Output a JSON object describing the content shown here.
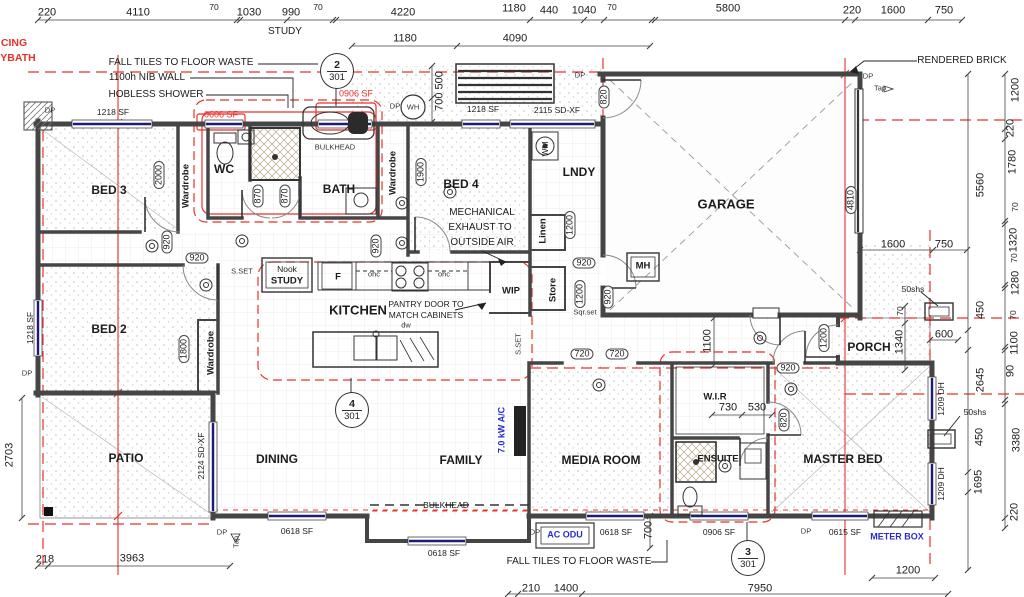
{
  "colors": {
    "red_line": "#e8312a",
    "window_blue": "#1b1b78",
    "label_blue": "#2a2ad0",
    "wall": "#454545"
  },
  "ref_circles": [
    {
      "num": "2",
      "sheet": "301"
    },
    {
      "num": "4",
      "sheet": "301"
    },
    {
      "num": "3",
      "sheet": "301"
    }
  ],
  "labels": [
    {
      "t": "220",
      "n": "dim-label",
      "k": "dim",
      "x": 47,
      "y": 13
    },
    {
      "t": "4110",
      "n": "dim-label",
      "k": "dim",
      "x": 138,
      "y": 13
    },
    {
      "t": "70",
      "n": "dim-label",
      "k": "dimsm",
      "x": 214,
      "y": 7
    },
    {
      "t": "1030",
      "n": "dim-label",
      "k": "dim",
      "x": 249,
      "y": 13
    },
    {
      "t": "990",
      "n": "dim-label",
      "k": "dim",
      "x": 291,
      "y": 13
    },
    {
      "t": "70",
      "n": "dim-label",
      "k": "dimsm",
      "x": 318,
      "y": 7
    },
    {
      "t": "4220",
      "n": "dim-label",
      "k": "dim",
      "x": 403,
      "y": 13
    },
    {
      "t": "1180",
      "n": "dim-label",
      "k": "dim",
      "x": 514,
      "y": 9
    },
    {
      "t": "440",
      "n": "dim-label",
      "k": "dim",
      "x": 549,
      "y": 11
    },
    {
      "t": "1040",
      "n": "dim-label",
      "k": "dim",
      "x": 584,
      "y": 11
    },
    {
      "t": "70",
      "n": "dim-label",
      "k": "dimsm",
      "x": 612,
      "y": 7
    },
    {
      "t": "5800",
      "n": "dim-label",
      "k": "dim",
      "x": 728,
      "y": 9
    },
    {
      "t": "220",
      "n": "dim-label",
      "k": "dim",
      "x": 852,
      "y": 11
    },
    {
      "t": "1600",
      "n": "dim-label",
      "k": "dim",
      "x": 893,
      "y": 11
    },
    {
      "t": "750",
      "n": "dim-label",
      "k": "dim",
      "x": 944,
      "y": 11
    },
    {
      "t": "STUDY",
      "n": "area-label-study",
      "k": "note",
      "x": 285,
      "y": 32
    },
    {
      "t": "1180",
      "n": "dim-label",
      "k": "dim",
      "x": 405,
      "y": 39
    },
    {
      "t": "4090",
      "n": "dim-label",
      "k": "dim",
      "x": 515,
      "y": 39
    },
    {
      "t": "700 500",
      "n": "dim-label",
      "k": "dim",
      "x": 440,
      "y": 91,
      "r": 1
    },
    {
      "t": "1200",
      "n": "dim-label",
      "k": "dim",
      "x": 1016,
      "y": 90,
      "r": 1
    },
    {
      "t": "220",
      "n": "dim-label",
      "k": "dim",
      "x": 1011,
      "y": 128,
      "r": 1
    },
    {
      "t": "1780",
      "n": "dim-label",
      "k": "dim",
      "x": 1013,
      "y": 162,
      "r": 1
    },
    {
      "t": "70",
      "n": "dim-label",
      "k": "dimsm",
      "x": 1015,
      "y": 207,
      "r": 1
    },
    {
      "t": "1320",
      "n": "dim-label",
      "k": "dim",
      "x": 1014,
      "y": 240,
      "r": 1
    },
    {
      "t": "70",
      "n": "dim-label",
      "k": "dimsm",
      "x": 1014,
      "y": 258,
      "r": 1
    },
    {
      "t": "1280",
      "n": "dim-label",
      "k": "dim",
      "x": 1016,
      "y": 283,
      "r": 1
    },
    {
      "t": "70",
      "n": "dim-label",
      "k": "dimsm",
      "x": 1013,
      "y": 315,
      "r": 1
    },
    {
      "t": "1100",
      "n": "dim-label",
      "k": "dim",
      "x": 1015,
      "y": 343,
      "r": 1
    },
    {
      "t": "90",
      "n": "dim-label",
      "k": "dim",
      "x": 1011,
      "y": 371,
      "r": 1
    },
    {
      "t": "3380",
      "n": "dim-label",
      "k": "dim",
      "x": 1017,
      "y": 440,
      "r": 1
    },
    {
      "t": "220",
      "n": "dim-label",
      "k": "dim",
      "x": 1015,
      "y": 512,
      "r": 1
    },
    {
      "t": "5560",
      "n": "dim-label",
      "k": "dim",
      "x": 981,
      "y": 185,
      "r": 1
    },
    {
      "t": "450",
      "n": "dim-label",
      "k": "dim",
      "x": 981,
      "y": 310,
      "r": 1
    },
    {
      "t": "2645",
      "n": "dim-label",
      "k": "dim",
      "x": 981,
      "y": 380,
      "r": 1
    },
    {
      "t": "450",
      "n": "dim-label",
      "k": "dim",
      "x": 980,
      "y": 437,
      "r": 1
    },
    {
      "t": "1695",
      "n": "dim-label",
      "k": "dim",
      "x": 979,
      "y": 482,
      "r": 1
    },
    {
      "t": "1600",
      "n": "dim-label",
      "k": "dim",
      "x": 893,
      "y": 245
    },
    {
      "t": "750",
      "n": "dim-label",
      "k": "dim",
      "x": 944,
      "y": 245
    },
    {
      "t": "50shs",
      "n": "post-label",
      "k": "dimsm",
      "x": 913,
      "y": 289
    },
    {
      "t": "70",
      "n": "dim-label",
      "k": "dimsm",
      "x": 900,
      "y": 311,
      "r": 1
    },
    {
      "t": "1340",
      "n": "dim-label",
      "k": "dim",
      "x": 900,
      "y": 342,
      "r": 1
    },
    {
      "t": "600",
      "n": "dim-label",
      "k": "dim",
      "x": 944,
      "y": 335
    },
    {
      "t": "50shs",
      "n": "post-label",
      "k": "dimsm",
      "x": 975,
      "y": 412
    },
    {
      "t": "1209 DH",
      "n": "window-size-label",
      "k": "dimsm",
      "x": 941,
      "y": 399,
      "r": 1
    },
    {
      "t": "1209 DH",
      "n": "window-size-label",
      "k": "dimsm",
      "x": 941,
      "y": 484,
      "r": 1
    },
    {
      "t": "1100",
      "n": "dim-label",
      "k": "dim",
      "x": 708,
      "y": 341,
      "r": 1
    },
    {
      "t": "218",
      "n": "dim-label",
      "k": "dim",
      "x": 45,
      "y": 560
    },
    {
      "t": "3963",
      "n": "dim-label",
      "k": "dim",
      "x": 132,
      "y": 559
    },
    {
      "t": "210",
      "n": "dim-label",
      "k": "dim",
      "x": 531,
      "y": 589
    },
    {
      "t": "1400",
      "n": "dim-label",
      "k": "dim",
      "x": 566,
      "y": 589
    },
    {
      "t": "7950",
      "n": "dim-label",
      "k": "dim",
      "x": 760,
      "y": 589
    },
    {
      "t": "1200",
      "n": "dim-label",
      "k": "dim",
      "x": 908,
      "y": 571
    },
    {
      "t": "700",
      "n": "dim-label",
      "k": "dim",
      "x": 649,
      "y": 530,
      "r": 1
    },
    {
      "t": "2703",
      "n": "dim-label",
      "k": "dim",
      "x": 10,
      "y": 455,
      "r": 1
    },
    {
      "t": "730",
      "n": "dim-label",
      "k": "dim",
      "x": 728,
      "y": 408
    },
    {
      "t": "530",
      "n": "dim-label",
      "k": "dim",
      "x": 757,
      "y": 408
    },
    {
      "t": "1218 SF",
      "n": "window-label",
      "k": "win",
      "x": 113,
      "y": 112
    },
    {
      "t": "0606 SF",
      "n": "window-label",
      "k": "winred",
      "x": 221,
      "y": 115
    },
    {
      "t": "0906 SF",
      "n": "window-label",
      "k": "winred",
      "x": 356,
      "y": 94
    },
    {
      "t": "1218 SF",
      "n": "window-label",
      "k": "win",
      "x": 483,
      "y": 109
    },
    {
      "t": "2115 SD-XF",
      "n": "window-label",
      "k": "win",
      "x": 557,
      "y": 110
    },
    {
      "t": "1218 SF",
      "n": "window-label",
      "k": "win",
      "x": 30,
      "y": 328,
      "r": 1
    },
    {
      "t": "2124 SD-XF",
      "n": "window-label",
      "k": "win",
      "x": 201,
      "y": 456,
      "r": 1
    },
    {
      "t": "0618 SF",
      "n": "window-label",
      "k": "win",
      "x": 297,
      "y": 531
    },
    {
      "t": "0618 SF",
      "n": "window-label",
      "k": "win",
      "x": 444,
      "y": 553
    },
    {
      "t": "0618 SF",
      "n": "window-label",
      "k": "win",
      "x": 616,
      "y": 532
    },
    {
      "t": "0906 SF",
      "n": "window-label",
      "k": "win",
      "x": 719,
      "y": 532
    },
    {
      "t": "0615 SF",
      "n": "window-label",
      "k": "win",
      "x": 845,
      "y": 532
    },
    {
      "t": "2000",
      "n": "door-size-tag",
      "k": "tag",
      "x": 159,
      "y": 175,
      "r": 1
    },
    {
      "t": "870",
      "n": "door-size-tag",
      "k": "tag",
      "x": 258,
      "y": 196,
      "r": 1
    },
    {
      "t": "870",
      "n": "door-size-tag",
      "k": "tag",
      "x": 285,
      "y": 196,
      "r": 1
    },
    {
      "t": "920",
      "n": "door-size-tag",
      "k": "tag",
      "x": 167,
      "y": 242,
      "r": 1
    },
    {
      "t": "920",
      "n": "door-size-tag",
      "k": "tag",
      "x": 197,
      "y": 258
    },
    {
      "t": "1800",
      "n": "door-size-tag",
      "k": "tag",
      "x": 184,
      "y": 349,
      "r": 1
    },
    {
      "t": "1900",
      "n": "door-size-tag",
      "k": "tag",
      "x": 421,
      "y": 172,
      "r": 1
    },
    {
      "t": "920",
      "n": "door-size-tag",
      "k": "tag",
      "x": 376,
      "y": 246,
      "r": 1
    },
    {
      "t": "1200",
      "n": "door-size-tag",
      "k": "tag",
      "x": 570,
      "y": 225,
      "r": 1
    },
    {
      "t": "920",
      "n": "door-size-tag",
      "k": "tag",
      "x": 584,
      "y": 263
    },
    {
      "t": "1200",
      "n": "door-size-tag",
      "k": "tag",
      "x": 580,
      "y": 294,
      "r": 1
    },
    {
      "t": "920",
      "n": "door-size-tag",
      "k": "tag",
      "x": 608,
      "y": 297,
      "r": 1
    },
    {
      "t": "820",
      "n": "door-size-tag",
      "k": "tag",
      "x": 604,
      "y": 97,
      "r": 1
    },
    {
      "t": "720",
      "n": "door-size-tag",
      "k": "tag",
      "x": 582,
      "y": 354
    },
    {
      "t": "720",
      "n": "door-size-tag",
      "k": "tag",
      "x": 617,
      "y": 354
    },
    {
      "t": "920",
      "n": "door-size-tag",
      "k": "tag",
      "x": 788,
      "y": 368
    },
    {
      "t": "820",
      "n": "door-size-tag",
      "k": "tag",
      "x": 784,
      "y": 420,
      "r": 1
    },
    {
      "t": "1200",
      "n": "door-size-tag",
      "k": "tag",
      "x": 824,
      "y": 338,
      "r": 1
    },
    {
      "t": "4810",
      "n": "door-size-tag",
      "k": "tag",
      "x": 851,
      "y": 200,
      "r": 1
    },
    {
      "t": "BED 3",
      "n": "room-label-bed3",
      "k": "room",
      "x": 109,
      "y": 190
    },
    {
      "t": "BED 2",
      "n": "room-label-bed2",
      "k": "room",
      "x": 109,
      "y": 329
    },
    {
      "t": "BED 4",
      "n": "room-label-bed4",
      "k": "room",
      "x": 461,
      "y": 184
    },
    {
      "t": "WC",
      "n": "room-label-wc",
      "k": "room",
      "x": 224,
      "y": 169
    },
    {
      "t": "BATH",
      "n": "room-label-bath",
      "k": "room",
      "x": 339,
      "y": 189
    },
    {
      "t": "LNDY",
      "n": "room-label-laundry",
      "k": "room",
      "x": 579,
      "y": 172
    },
    {
      "t": "GARAGE",
      "n": "room-label-garage",
      "k": "roomlg",
      "x": 726,
      "y": 204
    },
    {
      "t": "KITCHEN",
      "n": "room-label-kitchen",
      "k": "roomlg",
      "x": 358,
      "y": 310
    },
    {
      "t": "DINING",
      "n": "room-label-dining",
      "k": "room",
      "x": 277,
      "y": 459
    },
    {
      "t": "FAMILY",
      "n": "room-label-family",
      "k": "room",
      "x": 461,
      "y": 460
    },
    {
      "t": "MEDIA ROOM",
      "n": "room-label-media",
      "k": "room",
      "x": 601,
      "y": 460
    },
    {
      "t": "MASTER BED",
      "n": "room-label-master",
      "k": "room",
      "x": 843,
      "y": 459
    },
    {
      "t": "ENSUITE",
      "n": "room-label-ensuite",
      "k": "roomsm",
      "x": 718,
      "y": 459
    },
    {
      "t": "W.I.R",
      "n": "room-label-wir",
      "k": "roomsm",
      "x": 715,
      "y": 397
    },
    {
      "t": "PORCH",
      "n": "room-label-porch",
      "k": "room",
      "x": 869,
      "y": 347
    },
    {
      "t": "PATIO",
      "n": "room-label-patio",
      "k": "room",
      "x": 126,
      "y": 458
    },
    {
      "t": "WIP",
      "n": "room-label-wip",
      "k": "roomsm",
      "x": 511,
      "y": 291
    },
    {
      "t": "Nook",
      "n": "label-nook",
      "k": "notesm",
      "x": 287,
      "y": 269
    },
    {
      "t": "STUDY",
      "n": "label-study-nook",
      "k": "roomsm",
      "x": 287,
      "y": 281
    },
    {
      "t": "F",
      "n": "fridge-label",
      "k": "roomsm",
      "x": 338,
      "y": 277
    },
    {
      "t": "MH",
      "n": "manhole-label",
      "k": "roomsm",
      "x": 643,
      "y": 266
    },
    {
      "t": "Wardrobe",
      "n": "room-label-wardrobe",
      "k": "roomsm",
      "x": 186,
      "y": 186,
      "r": 1
    },
    {
      "t": "Wardrobe",
      "n": "room-label-wardrobe",
      "k": "roomsm",
      "x": 393,
      "y": 173,
      "r": 1
    },
    {
      "t": "Wardrobe",
      "n": "room-label-wardrobe",
      "k": "roomsm",
      "x": 211,
      "y": 353,
      "r": 1
    },
    {
      "t": "Linen",
      "n": "room-label-linen",
      "k": "roomsm",
      "x": 543,
      "y": 231,
      "r": 1
    },
    {
      "t": "Store",
      "n": "room-label-store",
      "k": "roomsm",
      "x": 553,
      "y": 290,
      "r": 1
    },
    {
      "t": "WM",
      "n": "washing-machine-label",
      "k": "notesm",
      "x": 545,
      "y": 149,
      "r": 1
    },
    {
      "t": "WH",
      "n": "water-heater-label",
      "k": "tiny",
      "x": 413,
      "y": 107
    },
    {
      "t": "FALL TILES TO FLOOR WASTE",
      "n": "annotation",
      "k": "note",
      "x": 181,
      "y": 63
    },
    {
      "t": "1100h NIB WALL",
      "n": "annotation",
      "k": "note",
      "x": 147,
      "y": 78
    },
    {
      "t": "HOBLESS SHOWER",
      "n": "annotation",
      "k": "note",
      "x": 156,
      "y": 95
    },
    {
      "t": "RENDERED BRICK",
      "n": "annotation",
      "k": "note",
      "x": 962,
      "y": 61
    },
    {
      "t": "MECHANICAL",
      "n": "annotation",
      "k": "note",
      "x": 482,
      "y": 213
    },
    {
      "t": "EXHAUST TO",
      "n": "annotation",
      "k": "note",
      "x": 480,
      "y": 228
    },
    {
      "t": "OUTSIDE AIR",
      "n": "annotation",
      "k": "note",
      "x": 482,
      "y": 243
    },
    {
      "t": "PANTRY DOOR TO",
      "n": "annotation",
      "k": "notesm",
      "x": 426,
      "y": 304
    },
    {
      "t": "MATCH CABINETS",
      "n": "annotation",
      "k": "notesm",
      "x": 426,
      "y": 315
    },
    {
      "t": "BULKHEAD",
      "n": "annotation",
      "k": "tiny",
      "x": 335,
      "y": 147
    },
    {
      "t": "BULKHEAD",
      "n": "annotation",
      "k": "notesm",
      "x": 446,
      "y": 505
    },
    {
      "t": "ohc",
      "n": "overhead-cupboard-label",
      "k": "tiny",
      "x": 374,
      "y": 274
    },
    {
      "t": "ohc",
      "n": "overhead-cupboard-label",
      "k": "tiny",
      "x": 444,
      "y": 274
    },
    {
      "t": "dw",
      "n": "dishwasher-label",
      "k": "tiny",
      "x": 406,
      "y": 325
    },
    {
      "t": "S.SET",
      "n": "annotation",
      "k": "tiny",
      "x": 242,
      "y": 271
    },
    {
      "t": "S.SET",
      "n": "annotation",
      "k": "tiny",
      "x": 518,
      "y": 344,
      "r": 1
    },
    {
      "t": "Sqr.set",
      "n": "annotation",
      "k": "tiny",
      "x": 585,
      "y": 312
    },
    {
      "t": "FALL TILES TO FLOOR WASTE",
      "n": "annotation",
      "k": "note",
      "x": 579,
      "y": 562
    },
    {
      "t": "7.0 kW A/C",
      "n": "ac-label",
      "k": "blue",
      "x": 502,
      "y": 430,
      "r": 1
    },
    {
      "t": "AC ODU",
      "n": "ac-odu-label",
      "k": "blue",
      "x": 565,
      "y": 535
    },
    {
      "t": "METER BOX",
      "n": "meter-box-label",
      "k": "blue",
      "x": 897,
      "y": 537
    },
    {
      "t": "CING",
      "n": "edge-text",
      "k": "redtxt",
      "x": 14,
      "y": 43
    },
    {
      "t": "YBATH",
      "n": "edge-text",
      "k": "redtxt",
      "x": 18,
      "y": 58
    },
    {
      "t": "DP",
      "n": "downpipe-label",
      "k": "tiny",
      "x": 50,
      "y": 110
    },
    {
      "t": "DP",
      "n": "downpipe-label",
      "k": "tiny",
      "x": 395,
      "y": 106
    },
    {
      "t": "DP",
      "n": "downpipe-label",
      "k": "tiny",
      "x": 580,
      "y": 75
    },
    {
      "t": "DP",
      "n": "downpipe-label",
      "k": "tiny",
      "x": 868,
      "y": 76
    },
    {
      "t": "Tap",
      "n": "tap-label",
      "k": "tiny",
      "x": 880,
      "y": 88
    },
    {
      "t": "DP",
      "n": "downpipe-label",
      "k": "tiny",
      "x": 27,
      "y": 373
    },
    {
      "t": "DP",
      "n": "downpipe-label",
      "k": "tiny",
      "x": 222,
      "y": 532
    },
    {
      "t": "DP",
      "n": "downpipe-label",
      "k": "tiny",
      "x": 535,
      "y": 532
    },
    {
      "t": "DP",
      "n": "downpipe-label",
      "k": "tiny",
      "x": 806,
      "y": 531
    },
    {
      "t": "Tap",
      "n": "tap-label",
      "k": "tiny",
      "x": 236,
      "y": 542,
      "r": 1
    }
  ]
}
